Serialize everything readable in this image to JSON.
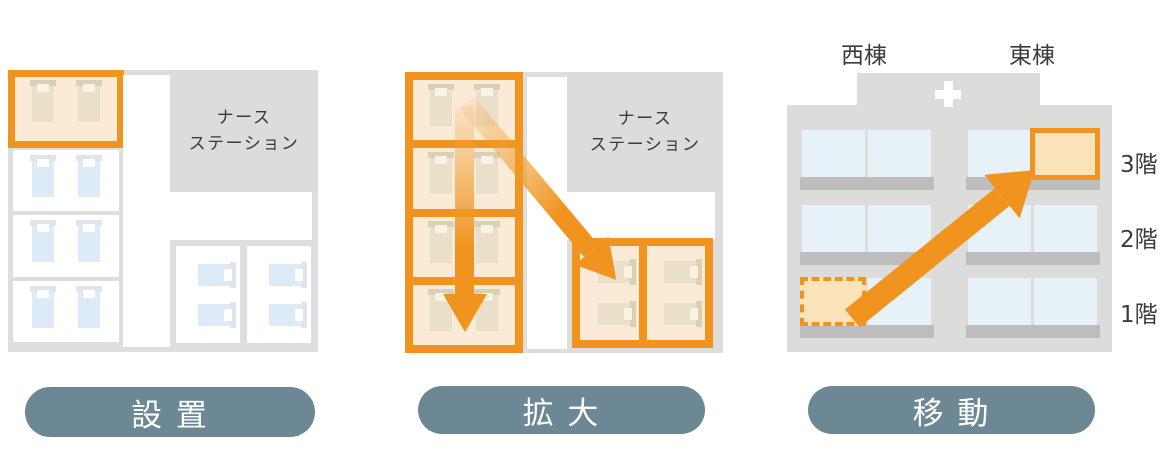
{
  "panels": [
    {
      "step_label": "設 置",
      "nurse_station": {
        "line1": "ナース",
        "line2": "ステーション"
      }
    },
    {
      "step_label": "拡 大",
      "nurse_station": {
        "line1": "ナース",
        "line2": "ステーション"
      }
    },
    {
      "step_label": "移 動",
      "building": {
        "west_wing_label": "西棟",
        "east_wing_label": "東棟",
        "floor_labels": [
          "3階",
          "2階",
          "1階"
        ]
      }
    }
  ],
  "colors": {
    "accent_orange": "#F0941F",
    "highlight_room_fill": "#FAEAD6",
    "building_room_fill": "#FAE3B8",
    "step_pill_background": "#6B8894",
    "step_pill_text": "#FFFFFF",
    "floor_plan_gray": "#DEDEDC",
    "nurse_station_gray": "#DCDCDA",
    "building_gray": "#DCDCDB",
    "window_sill_gray": "#BDBDBD",
    "window_blue": "#E6F1F8",
    "bed_blue": "#DCEBF7",
    "bed_tan": "#EADFC8",
    "label_text": "#3E3A39"
  }
}
